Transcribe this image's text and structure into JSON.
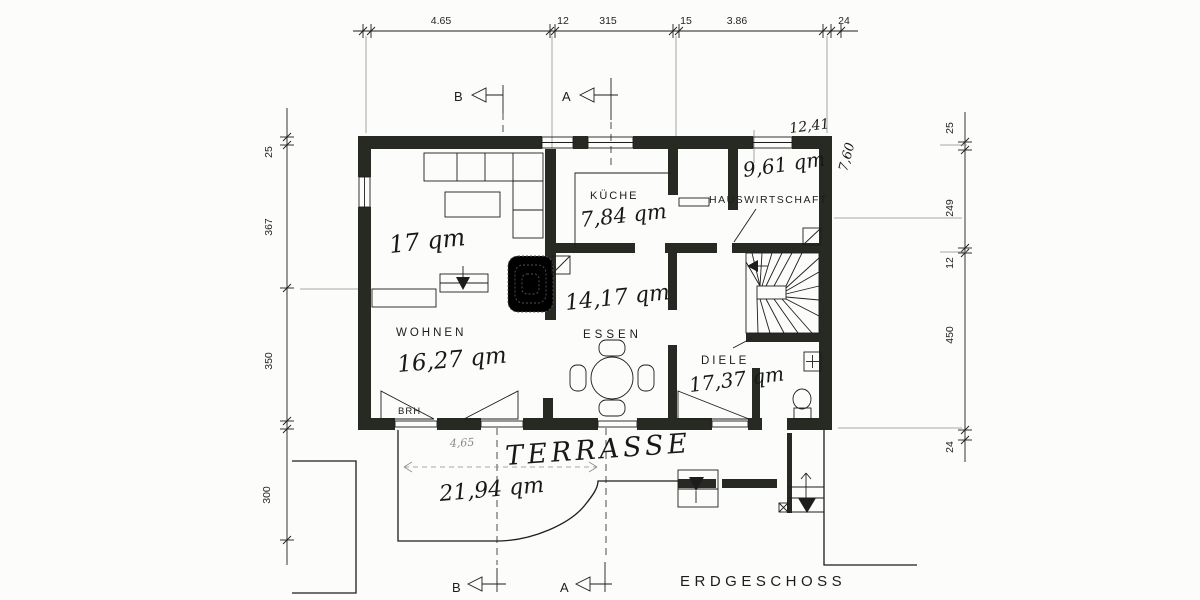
{
  "drawing": {
    "floor_label": "ERDGESCHOSS",
    "rooms": {
      "wohnen": {
        "name": "WOHNEN",
        "area": "16,27 qm",
        "area_note": "17 qm"
      },
      "kueche": {
        "name": "KÜCHE",
        "area": "7,84 qm"
      },
      "hauswirtschaft": {
        "name": "HAUSWIRTSCHAFT",
        "area": "9,61 qm"
      },
      "essen": {
        "name": "ESSEN",
        "area": "14,17 qm"
      },
      "diele": {
        "name": "DIELE",
        "area": "17,37 qm"
      },
      "terrasse": {
        "name": "TERRASSE",
        "area": "21,94 qm"
      }
    },
    "dimensions": {
      "top": [
        "4.65",
        "12",
        "315",
        "15",
        "3.86",
        "24"
      ],
      "left": [
        "25",
        "367",
        "350",
        "300"
      ],
      "right": [
        "25",
        "249",
        "12",
        "450",
        "24"
      ],
      "overall_width": "12,41",
      "overall_depth": "7,60",
      "terrace_width": "4,65"
    },
    "annotations": {
      "brh": "BRH"
    },
    "section_markers": {
      "b": "B",
      "a": "A"
    },
    "colors": {
      "ink": "#1d1d1d",
      "wall": "#262a23",
      "paper": "#fcfcfa"
    }
  }
}
